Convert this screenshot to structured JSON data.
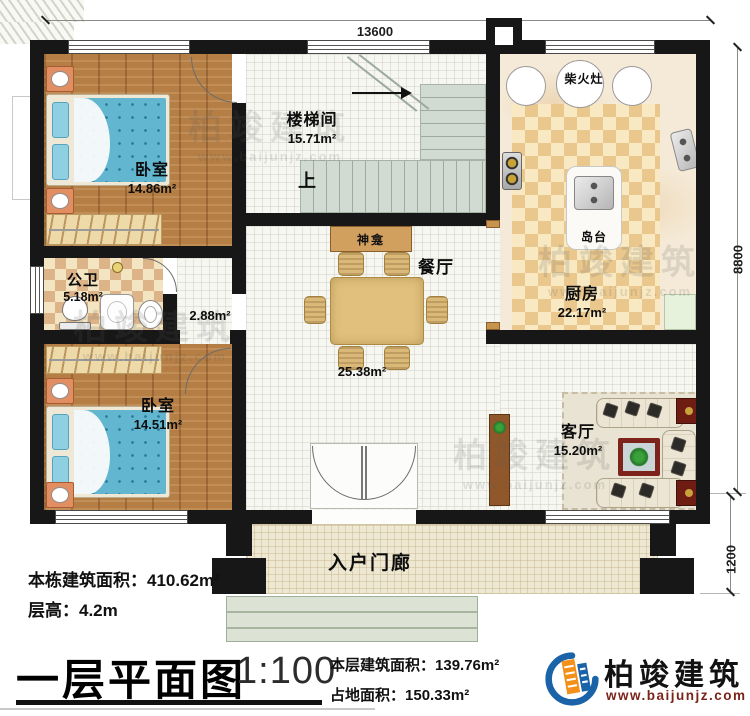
{
  "dims": {
    "top": "13600",
    "right": "8800",
    "lower": "1200"
  },
  "rooms": {
    "bedroom_top": {
      "label": "卧室",
      "area": "14.86m²"
    },
    "stairwell": {
      "label": "楼梯间",
      "area": "15.71m²"
    },
    "kitchen": {
      "label": "厨房",
      "area": "22.17m²"
    },
    "bathroom": {
      "label": "公卫",
      "area": "5.18m²"
    },
    "bedroom_bottom": {
      "label": "卧室",
      "area": "14.51m²"
    },
    "dining": {
      "label": "餐厅",
      "area": "25.38m²"
    },
    "living": {
      "label": "客厅",
      "area": "15.20m²"
    },
    "hallway": {
      "area": "2.88m²"
    },
    "porch": {
      "label": "入户门廊"
    }
  },
  "labels": {
    "stove": "柴火灶",
    "island": "岛台",
    "shrine": "神龛",
    "up": "上"
  },
  "info": {
    "total_label": "本栋建筑面积：",
    "total_value": "410.62m²",
    "height_label": "层高：",
    "height_value": "4.2m"
  },
  "titlebar": {
    "title": "一层平面图",
    "scale": "1:100",
    "floor_label": "本层建筑面积：",
    "floor_value": "139.76m²",
    "land_label": "占地面积：",
    "land_value": "150.33m²"
  },
  "brand": {
    "name": "柏竣建筑",
    "url": "www.baijunjz.com"
  }
}
